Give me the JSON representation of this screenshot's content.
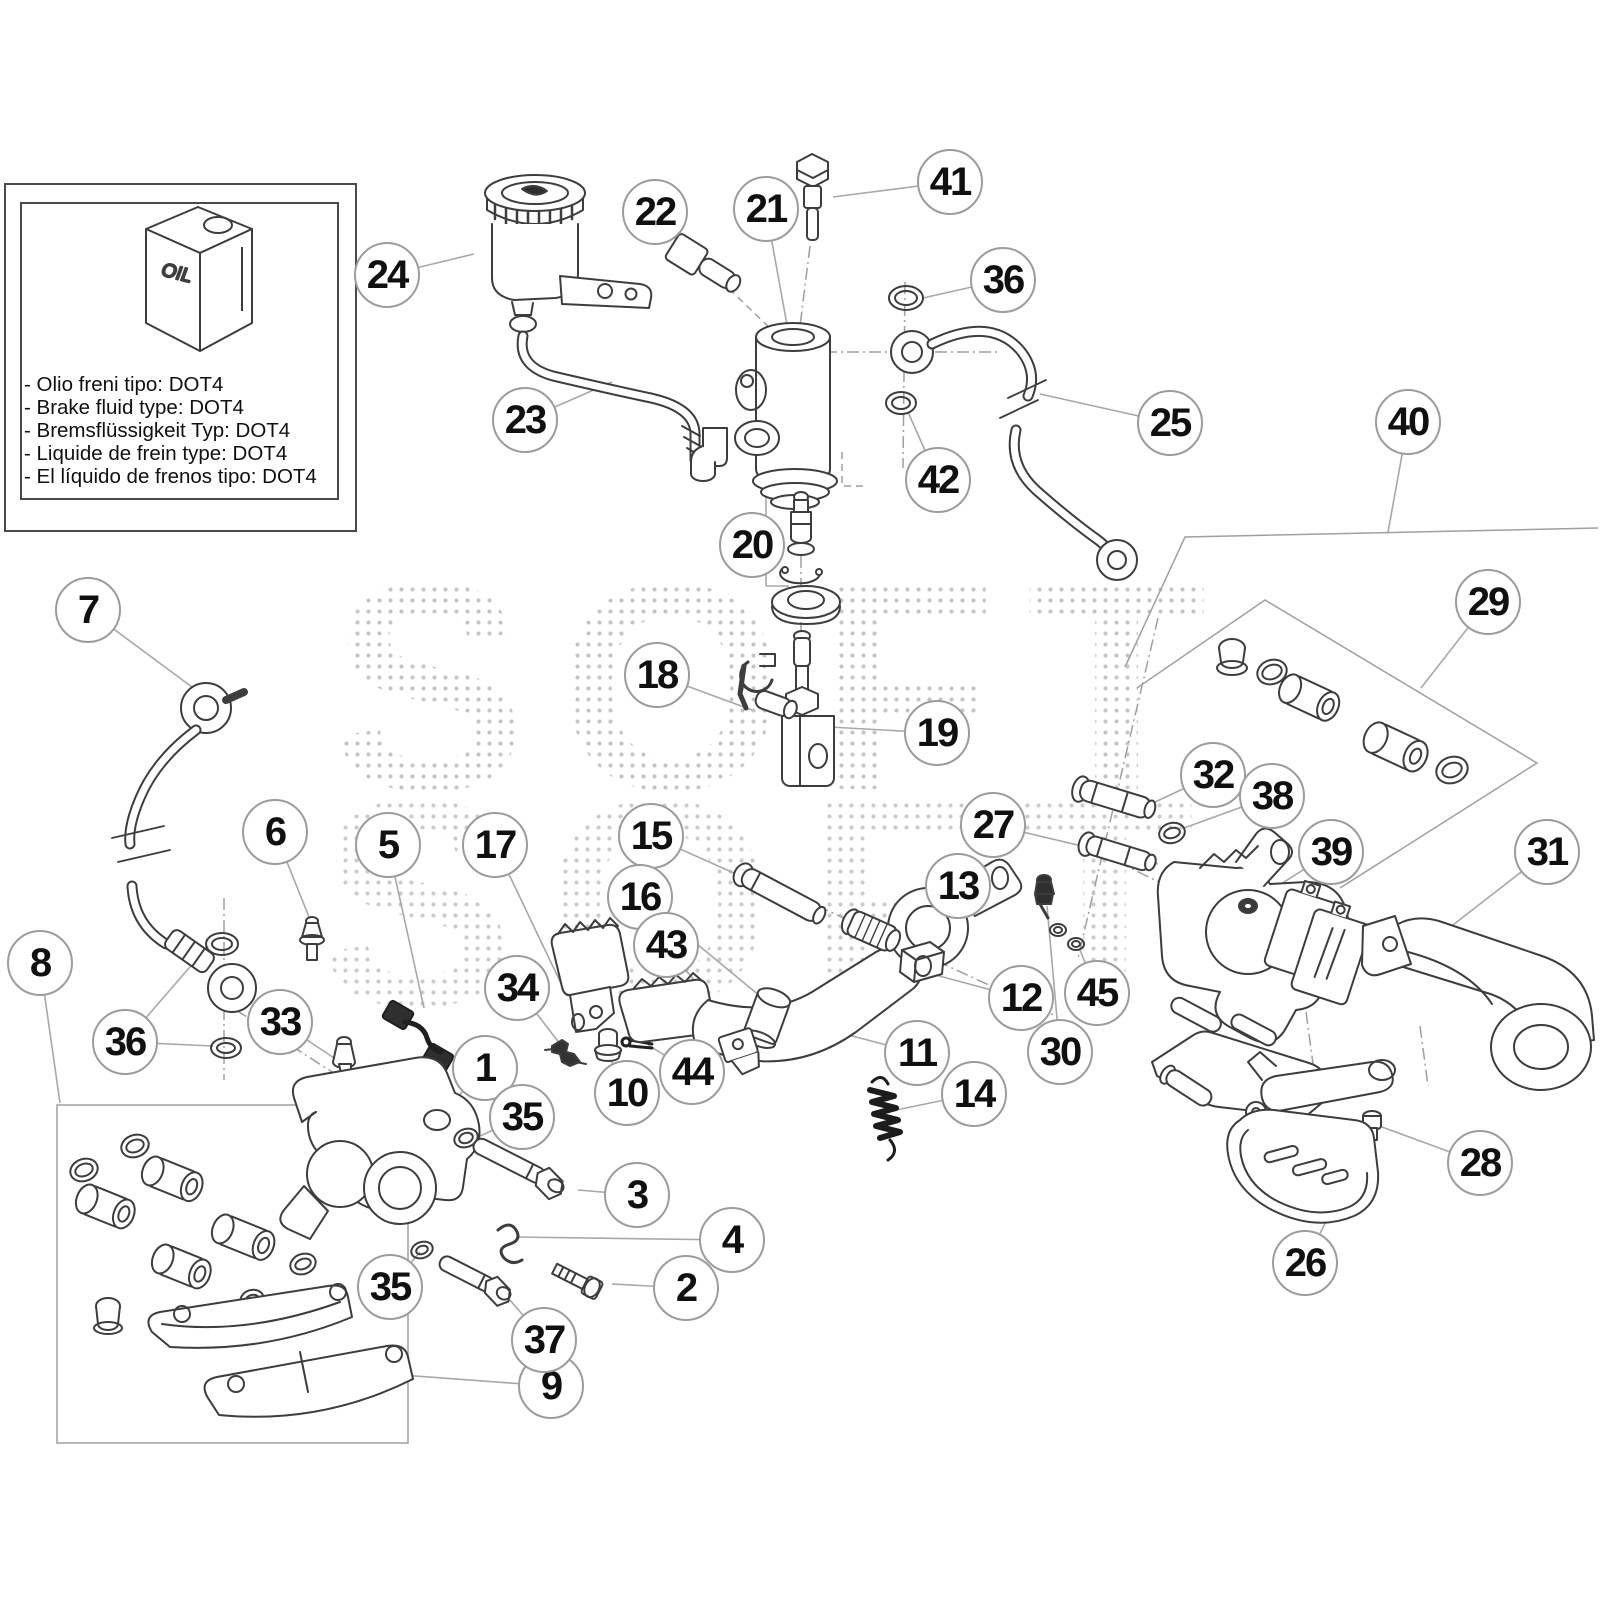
{
  "note_box": {
    "lines": [
      "- Olio freni tipo: DOT4",
      "- Brake fluid type: DOT4",
      "- Bremsflüssigkeit Typ: DOT4",
      "- Liquide de frein type: DOT4",
      "- El líquido de frenos tipo: DOT4"
    ],
    "can_label": "OIL"
  },
  "watermark": {
    "text": "SOFT"
  },
  "colors": {
    "line": "#3d3d3d",
    "leader": "#a8a8a8",
    "circle_border": "#9c9c9c",
    "text": "#101010"
  },
  "callouts": [
    {
      "n": "1",
      "x": 485,
      "y": 1068,
      "s": [
        [
          485,
          1068,
          450,
          1105
        ]
      ]
    },
    {
      "n": "2",
      "x": 686,
      "y": 1288,
      "s": [
        [
          686,
          1288,
          612,
          1284
        ]
      ]
    },
    {
      "n": "3",
      "x": 637,
      "y": 1195,
      "s": [
        [
          637,
          1195,
          578,
          1190
        ]
      ]
    },
    {
      "n": "4",
      "x": 732,
      "y": 1240,
      "s": [
        [
          732,
          1240,
          516,
          1237
        ]
      ]
    },
    {
      "n": "5",
      "x": 388,
      "y": 845,
      "s": [
        [
          388,
          845,
          424,
          1008
        ]
      ]
    },
    {
      "n": "6",
      "x": 275,
      "y": 832,
      "s": [
        [
          275,
          832,
          311,
          922
        ]
      ]
    },
    {
      "n": "7",
      "x": 88,
      "y": 610,
      "s": [
        [
          88,
          610,
          196,
          690
        ]
      ]
    },
    {
      "n": "8",
      "x": 40,
      "y": 963,
      "s": [
        [
          40,
          963,
          60,
          1103
        ]
      ]
    },
    {
      "n": "9",
      "x": 551,
      "y": 1386,
      "s": [
        [
          551,
          1386,
          362,
          1372
        ]
      ]
    },
    {
      "n": "10",
      "x": 627,
      "y": 1093,
      "s": [
        [
          627,
          1093,
          609,
          1056
        ]
      ]
    },
    {
      "n": "11",
      "x": 917,
      "y": 1053,
      "s": [
        [
          917,
          1053,
          746,
          1008
        ]
      ]
    },
    {
      "n": "12",
      "x": 1021,
      "y": 998,
      "s": [
        [
          1021,
          998,
          932,
          974
        ]
      ]
    },
    {
      "n": "13",
      "x": 958,
      "y": 886,
      "s": [
        [
          958,
          886,
          890,
          930
        ]
      ]
    },
    {
      "n": "14",
      "x": 974,
      "y": 1094,
      "s": [
        [
          974,
          1094,
          896,
          1110
        ]
      ]
    },
    {
      "n": "15",
      "x": 651,
      "y": 836,
      "s": [
        [
          651,
          836,
          772,
          890
        ]
      ]
    },
    {
      "n": "16",
      "x": 640,
      "y": 897,
      "s": [
        [
          640,
          897,
          772,
          1006
        ]
      ]
    },
    {
      "n": "17",
      "x": 495,
      "y": 845,
      "s": [
        [
          495,
          845,
          567,
          996
        ]
      ]
    },
    {
      "n": "18",
      "x": 657,
      "y": 675,
      "s": [
        [
          657,
          675,
          752,
          710
        ]
      ]
    },
    {
      "n": "19",
      "x": 937,
      "y": 733,
      "s": [
        [
          937,
          733,
          812,
          726
        ]
      ]
    },
    {
      "n": "20",
      "x": 752,
      "y": 545,
      "s": [
        [
          752,
          545,
          766,
          545
        ],
        [
          766,
          492,
          766,
          586
        ],
        [
          766,
          492,
          789,
          492
        ],
        [
          766,
          586,
          789,
          586
        ]
      ]
    },
    {
      "n": "21",
      "x": 766,
      "y": 209,
      "s": [
        [
          766,
          209,
          789,
          336
        ]
      ]
    },
    {
      "n": "22",
      "x": 655,
      "y": 212,
      "s": [
        [
          655,
          212,
          694,
          254
        ]
      ]
    },
    {
      "n": "23",
      "x": 525,
      "y": 420,
      "s": [
        [
          525,
          420,
          612,
          382
        ]
      ]
    },
    {
      "n": "24",
      "x": 387,
      "y": 275,
      "s": [
        [
          387,
          275,
          474,
          254
        ]
      ]
    },
    {
      "n": "25",
      "x": 1170,
      "y": 423,
      "s": [
        [
          1170,
          423,
          1040,
          394
        ]
      ]
    },
    {
      "n": "26",
      "x": 1305,
      "y": 1263,
      "s": [
        [
          1305,
          1263,
          1338,
          1198
        ]
      ]
    },
    {
      "n": "27",
      "x": 993,
      "y": 825,
      "s": [
        [
          993,
          825,
          1158,
          864
        ]
      ]
    },
    {
      "n": "28",
      "x": 1480,
      "y": 1163,
      "s": [
        [
          1480,
          1163,
          1382,
          1127
        ]
      ]
    },
    {
      "n": "29",
      "x": 1488,
      "y": 602,
      "s": [
        [
          1488,
          602,
          1421,
          688
        ]
      ]
    },
    {
      "n": "30",
      "x": 1060,
      "y": 1052,
      "s": [
        [
          1060,
          1052,
          1047,
          906
        ]
      ]
    },
    {
      "n": "31",
      "x": 1547,
      "y": 852,
      "s": [
        [
          1547,
          852,
          1449,
          928
        ]
      ]
    },
    {
      "n": "32",
      "x": 1213,
      "y": 775,
      "s": [
        [
          1213,
          775,
          1155,
          802
        ]
      ]
    },
    {
      "n": "33",
      "x": 280,
      "y": 1022,
      "s": [
        [
          280,
          1022,
          340,
          1062
        ]
      ]
    },
    {
      "n": "34",
      "x": 517,
      "y": 988,
      "s": [
        [
          517,
          988,
          560,
          1044
        ]
      ]
    },
    {
      "n": "35",
      "x": 522,
      "y": 1117,
      "s": [
        [
          522,
          1117,
          480,
          1136
        ]
      ]
    },
    {
      "n": "35",
      "x": 390,
      "y": 1287,
      "s": [
        [
          390,
          1287,
          420,
          1252
        ]
      ]
    },
    {
      "n": "36",
      "x": 1003,
      "y": 280,
      "s": [
        [
          1003,
          280,
          923,
          298
        ]
      ]
    },
    {
      "n": "36",
      "x": 125,
      "y": 1042,
      "s": [
        [
          125,
          1042,
          208,
          946
        ],
        [
          125,
          1042,
          213,
          1046
        ]
      ]
    },
    {
      "n": "37",
      "x": 544,
      "y": 1340,
      "s": [
        [
          544,
          1340,
          510,
          1300
        ]
      ]
    },
    {
      "n": "38",
      "x": 1272,
      "y": 796,
      "s": [
        [
          1272,
          796,
          1184,
          828
        ]
      ]
    },
    {
      "n": "39",
      "x": 1331,
      "y": 852,
      "s": [
        [
          1331,
          852,
          1256,
          900
        ]
      ]
    },
    {
      "n": "40",
      "x": 1408,
      "y": 422,
      "s": [
        [
          1408,
          422,
          1388,
          532
        ]
      ]
    },
    {
      "n": "41",
      "x": 950,
      "y": 182,
      "s": [
        [
          950,
          182,
          833,
          197
        ]
      ]
    },
    {
      "n": "42",
      "x": 938,
      "y": 480,
      "s": [
        [
          938,
          480,
          908,
          412
        ]
      ]
    },
    {
      "n": "43",
      "x": 666,
      "y": 945,
      "s": [
        [
          666,
          945,
          740,
          1038
        ]
      ]
    },
    {
      "n": "44",
      "x": 692,
      "y": 1072,
      "s": [
        [
          692,
          1072,
          648,
          1045
        ]
      ]
    },
    {
      "n": "45",
      "x": 1097,
      "y": 993,
      "s": [
        [
          1097,
          993,
          1080,
          950
        ]
      ]
    }
  ]
}
